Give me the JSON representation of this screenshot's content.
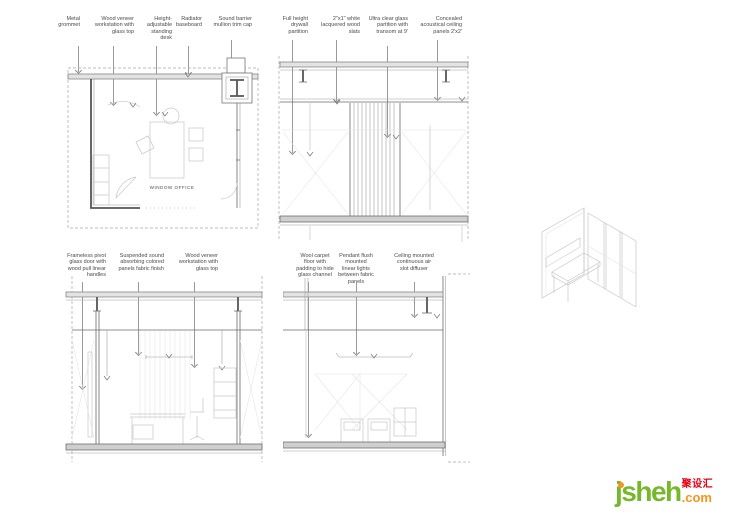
{
  "annotations": {
    "top": [
      {
        "text": "Metal grommet"
      },
      {
        "text": "Wood veneer workstation with glass top"
      },
      {
        "text": "Height-adjustable standing desk"
      },
      {
        "text": "Radiator baseboard"
      },
      {
        "text": "Sound barrier mullion trim cap"
      },
      {
        "text": "Full height drywall partition"
      },
      {
        "text": "2\"x1\" white lacquered wood slats"
      },
      {
        "text": "Ultra clear glass partition with transom at 9'"
      },
      {
        "text": "Concealed acoustical ceiling panels 2'x2'"
      }
    ],
    "bottom": [
      {
        "text": "Frameless pivot glass door with wood pull linear handles"
      },
      {
        "text": "Suspended sound absorbing colored panels fabric finish"
      },
      {
        "text": "Wood veneer workstation with glass top"
      },
      {
        "text": "Wool carpet floor with padding to hide glass channel"
      },
      {
        "text": "Pendant flush mounted linear lights between fabric panels"
      },
      {
        "text": "Ceiling mounted continuous air slot diffuser"
      }
    ]
  },
  "drawings": {
    "plan": {
      "room_label": "WINDOW OFFICE"
    }
  },
  "logo": {
    "wordmark": "jsheh",
    "domain_suffix": ".com",
    "chinese_name": "聚设汇",
    "colors": {
      "green": "#76b82a",
      "orange": "#f7941e",
      "red": "#e60012"
    }
  }
}
